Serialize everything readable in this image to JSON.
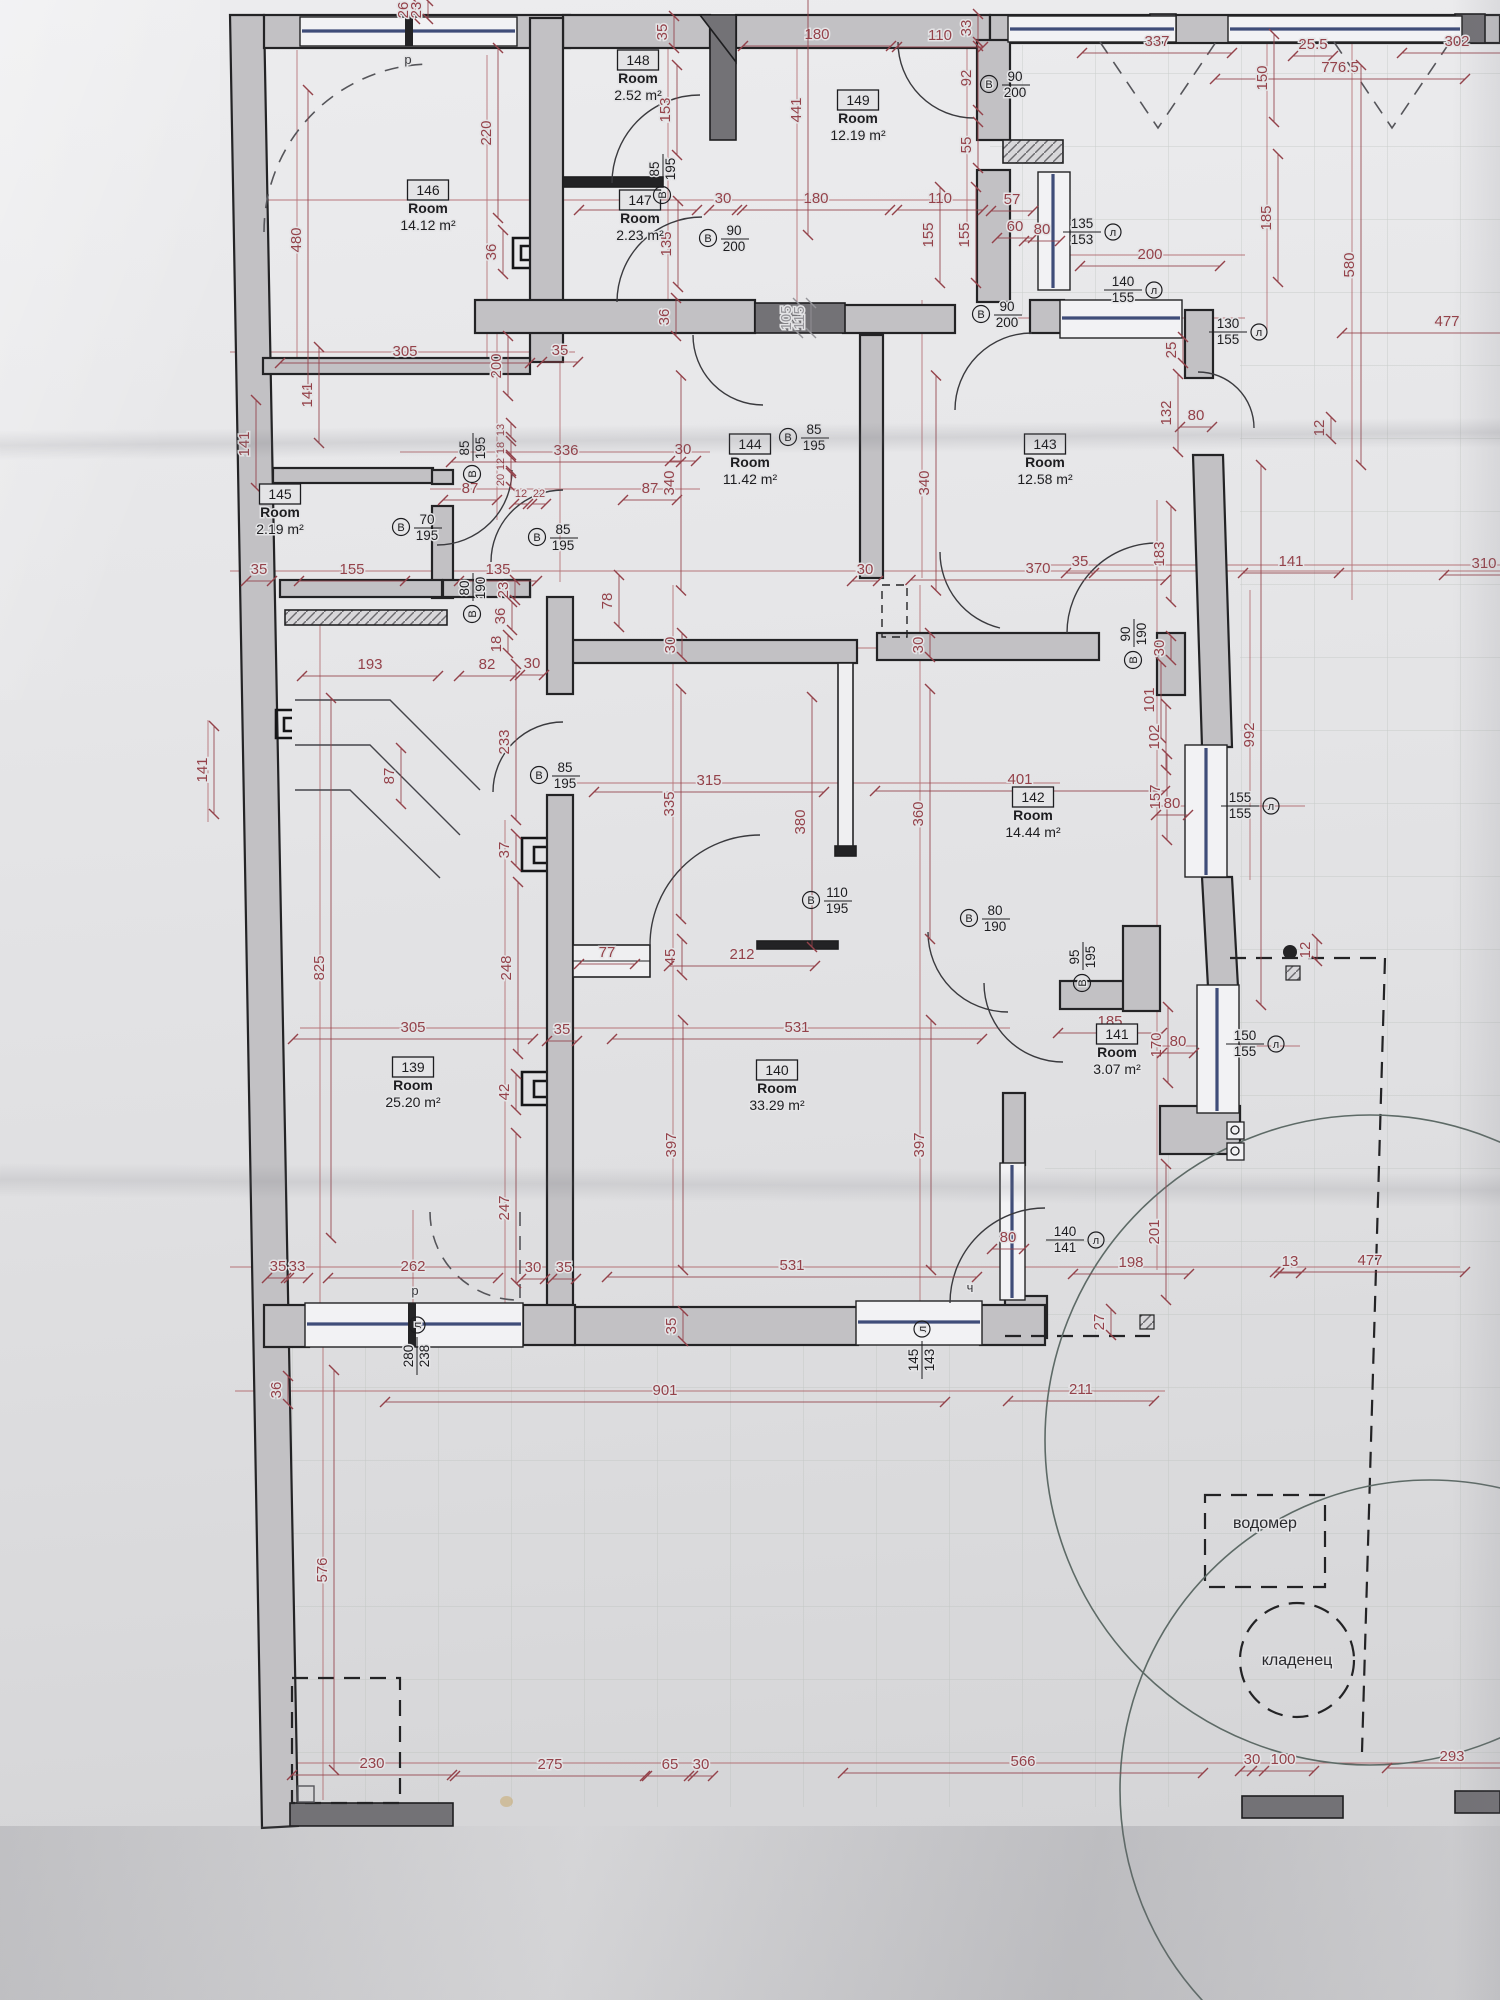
{
  "doc": {
    "kind": "floor plan scan",
    "language": "bg"
  },
  "legend": {
    "door_letter": "В",
    "window_letter": "л"
  },
  "colors": {
    "dim": "#94424a",
    "ink": "#1d1d20",
    "wall": "#c2c1c4",
    "wall_dark": "#737276",
    "glass": "#3f4d79",
    "paper": "#e4e4e6",
    "muted": "#96959a"
  },
  "rooms": [
    {
      "id": "146",
      "label": "Room",
      "area": "14.12 m²",
      "x": 428,
      "y": 208
    },
    {
      "id": "148",
      "label": "Room",
      "area": "2.52 m²",
      "x": 638,
      "y": 78
    },
    {
      "id": "149",
      "label": "Room",
      "area": "12.19 m²",
      "x": 858,
      "y": 118
    },
    {
      "id": "147",
      "label": "Room",
      "area": "2.23 m²",
      "x": 640,
      "y": 218
    },
    {
      "id": "144",
      "label": "Room",
      "area": "11.42 m²",
      "x": 750,
      "y": 462
    },
    {
      "id": "143",
      "label": "Room",
      "area": "12.58 m²",
      "x": 1045,
      "y": 462
    },
    {
      "id": "145",
      "label": "Room",
      "area": "2.19 m²",
      "x": 280,
      "y": 512
    },
    {
      "id": "142",
      "label": "Room",
      "area": "14.44 m²",
      "x": 1033,
      "y": 815
    },
    {
      "id": "141",
      "label": "Room",
      "area": "3.07 m²",
      "x": 1117,
      "y": 1052
    },
    {
      "id": "139",
      "label": "Room",
      "area": "25.20 m²",
      "x": 413,
      "y": 1085
    },
    {
      "id": "140",
      "label": "Room",
      "area": "33.29 m²",
      "x": 777,
      "y": 1088
    }
  ],
  "dims": [
    {
      "t": "26",
      "x": 404,
      "y": 10,
      "r": 1,
      "s": 18
    },
    {
      "t": "23",
      "x": 417,
      "y": 10,
      "r": 1,
      "s": 18
    },
    {
      "t": "220",
      "x": 487,
      "y": 133,
      "r": 1,
      "s": 170
    },
    {
      "t": "480",
      "x": 297,
      "y": 240,
      "r": 1,
      "s": 300
    },
    {
      "t": "305",
      "x": 405,
      "y": 352,
      "s": 250
    },
    {
      "t": "200",
      "x": 497,
      "y": 366,
      "r": 1,
      "s": 60
    },
    {
      "t": "35",
      "x": 560,
      "y": 351,
      "s": 36
    },
    {
      "t": "36",
      "x": 492,
      "y": 252,
      "r": 1,
      "s": 44
    },
    {
      "t": "35",
      "x": 663,
      "y": 32,
      "r": 1,
      "s": 32
    },
    {
      "t": "153",
      "x": 666,
      "y": 110,
      "r": 1,
      "s": 90
    },
    {
      "t": "165",
      "x": 638,
      "y": 199,
      "s": 118
    },
    {
      "t": "30",
      "x": 723,
      "y": 199,
      "s": 28
    },
    {
      "t": "180",
      "x": 816,
      "y": 199,
      "s": 148
    },
    {
      "t": "135",
      "x": 667,
      "y": 244,
      "r": 1,
      "s": 86
    },
    {
      "t": "36",
      "x": 665,
      "y": 317,
      "r": 1,
      "s": 38
    },
    {
      "t": "180",
      "x": 817,
      "y": 35,
      "s": 148
    },
    {
      "t": "441",
      "x": 797,
      "y": 110,
      "r": 1,
      "s": 250
    },
    {
      "t": "110",
      "x": 940,
      "y": 36,
      "s": 86
    },
    {
      "t": "33",
      "x": 967,
      "y": 28,
      "r": 1,
      "s": 28
    },
    {
      "t": "92",
      "x": 967,
      "y": 78,
      "r": 1,
      "s": 64
    },
    {
      "t": "55",
      "x": 967,
      "y": 145,
      "r": 1,
      "s": 46
    },
    {
      "t": "110",
      "x": 940,
      "y": 199,
      "s": 86
    },
    {
      "t": "57",
      "x": 1012,
      "y": 200,
      "s": 42
    },
    {
      "t": "155",
      "x": 929,
      "y": 235,
      "r": 1,
      "s": 96
    },
    {
      "t": "155",
      "x": 965,
      "y": 235,
      "r": 1,
      "s": 96
    },
    {
      "t": "60",
      "x": 1015,
      "y": 227,
      "s": 36
    },
    {
      "t": "80",
      "x": 1042,
      "y": 230,
      "s": 36
    },
    {
      "t": "337",
      "x": 1157,
      "y": 42,
      "s": 150
    },
    {
      "t": "25.5",
      "x": 1313,
      "y": 45,
      "s": 40
    },
    {
      "t": "776.5",
      "x": 1340,
      "y": 68,
      "s": 250
    },
    {
      "t": "150",
      "x": 1263,
      "y": 78,
      "r": 1,
      "s": 88
    },
    {
      "t": "302",
      "x": 1457,
      "y": 42,
      "s": 110
    },
    {
      "t": "200",
      "x": 1150,
      "y": 255,
      "s": 140
    },
    {
      "t": "477",
      "x": 1447,
      "y": 322,
      "s": 210
    },
    {
      "t": "580",
      "x": 1350,
      "y": 265,
      "r": 1,
      "s": 400
    },
    {
      "t": "185",
      "x": 1267,
      "y": 218,
      "r": 1,
      "s": 128
    },
    {
      "t": "105",
      "x": 787,
      "y": 318,
      "r": 1,
      "s": 30,
      "c": "muted"
    },
    {
      "t": "115",
      "x": 800,
      "y": 318,
      "r": 1,
      "s": 30,
      "c": "muted"
    },
    {
      "t": "13",
      "x": 500,
      "y": 430,
      "r": 1,
      "s": 14,
      "f": 11
    },
    {
      "t": "18",
      "x": 500,
      "y": 448,
      "r": 1,
      "s": 14,
      "f": 11
    },
    {
      "t": "12",
      "x": 500,
      "y": 464,
      "r": 1,
      "s": 14,
      "f": 11
    },
    {
      "t": "20",
      "x": 500,
      "y": 480,
      "r": 1,
      "s": 14,
      "f": 11
    },
    {
      "t": "12",
      "x": 521,
      "y": 493,
      "s": 14,
      "f": 11
    },
    {
      "t": "22",
      "x": 539,
      "y": 493,
      "s": 14,
      "f": 11
    },
    {
      "t": "141",
      "x": 308,
      "y": 395,
      "r": 1,
      "s": 96
    },
    {
      "t": "141",
      "x": 245,
      "y": 444,
      "r": 1,
      "s": 88
    },
    {
      "t": "87",
      "x": 470,
      "y": 489,
      "s": 54
    },
    {
      "t": "87",
      "x": 650,
      "y": 489,
      "s": 54
    },
    {
      "t": "336",
      "x": 566,
      "y": 451,
      "s": 230
    },
    {
      "t": "30",
      "x": 683,
      "y": 450,
      "s": 26
    },
    {
      "t": "340",
      "x": 670,
      "y": 483,
      "r": 1,
      "s": 215
    },
    {
      "t": "340",
      "x": 925,
      "y": 483,
      "r": 1,
      "s": 215
    },
    {
      "t": "370",
      "x": 1038,
      "y": 569,
      "s": 255
    },
    {
      "t": "30",
      "x": 865,
      "y": 570,
      "s": 26
    },
    {
      "t": "35",
      "x": 1080,
      "y": 562,
      "s": 28
    },
    {
      "t": "141",
      "x": 1291,
      "y": 562,
      "s": 96
    },
    {
      "t": "310",
      "x": 1484,
      "y": 564,
      "s": 80
    },
    {
      "t": "12",
      "x": 1320,
      "y": 428,
      "r": 1,
      "s": 22
    },
    {
      "t": "25",
      "x": 1172,
      "y": 350,
      "r": 1,
      "s": 26
    },
    {
      "t": "132",
      "x": 1167,
      "y": 413,
      "r": 1,
      "s": 78
    },
    {
      "t": "80",
      "x": 1196,
      "y": 416,
      "s": 32
    },
    {
      "t": "183",
      "x": 1160,
      "y": 554,
      "r": 1,
      "s": 96
    },
    {
      "t": "155",
      "x": 352,
      "y": 570,
      "s": 106
    },
    {
      "t": "35",
      "x": 259,
      "y": 570,
      "s": 26
    },
    {
      "t": "135",
      "x": 498,
      "y": 570,
      "s": 78
    },
    {
      "t": "23",
      "x": 504,
      "y": 590,
      "r": 1,
      "s": 20
    },
    {
      "t": "36",
      "x": 501,
      "y": 616,
      "r": 1,
      "s": 28
    },
    {
      "t": "18",
      "x": 497,
      "y": 644,
      "r": 1,
      "s": 18
    },
    {
      "t": "193",
      "x": 370,
      "y": 665,
      "s": 136
    },
    {
      "t": "82",
      "x": 487,
      "y": 665,
      "s": 56
    },
    {
      "t": "30",
      "x": 532,
      "y": 664,
      "s": 24
    },
    {
      "t": "233",
      "x": 505,
      "y": 742,
      "r": 1,
      "s": 156
    },
    {
      "t": "141",
      "x": 203,
      "y": 770,
      "r": 1,
      "s": 88
    },
    {
      "t": "87",
      "x": 390,
      "y": 776,
      "r": 1,
      "s": 56
    },
    {
      "t": "78",
      "x": 608,
      "y": 601,
      "r": 1,
      "s": 52
    },
    {
      "t": "30",
      "x": 671,
      "y": 645,
      "r": 1,
      "s": 24
    },
    {
      "t": "30",
      "x": 919,
      "y": 645,
      "r": 1,
      "s": 24
    },
    {
      "t": "315",
      "x": 709,
      "y": 781,
      "s": 230
    },
    {
      "t": "335",
      "x": 670,
      "y": 804,
      "r": 1,
      "s": 230
    },
    {
      "t": "380",
      "x": 801,
      "y": 822,
      "r": 1,
      "s": 250
    },
    {
      "t": "360",
      "x": 919,
      "y": 814,
      "r": 1,
      "s": 250
    },
    {
      "t": "401",
      "x": 1020,
      "y": 780,
      "s": 290
    },
    {
      "t": "157",
      "x": 1156,
      "y": 797,
      "r": 1,
      "s": 86
    },
    {
      "t": "80",
      "x": 1172,
      "y": 804,
      "s": 32
    },
    {
      "t": "992",
      "x": 1250,
      "y": 735,
      "r": 1,
      "s": 540
    },
    {
      "t": "101",
      "x": 1150,
      "y": 700,
      "r": 1,
      "s": 76
    },
    {
      "t": "102",
      "x": 1155,
      "y": 737,
      "r": 1,
      "s": 66
    },
    {
      "t": "30",
      "x": 1160,
      "y": 648,
      "r": 1,
      "s": 24
    },
    {
      "t": "825",
      "x": 320,
      "y": 968,
      "r": 1,
      "s": 540
    },
    {
      "t": "248",
      "x": 507,
      "y": 968,
      "r": 1,
      "s": 172
    },
    {
      "t": "37",
      "x": 505,
      "y": 850,
      "r": 1,
      "s": 32
    },
    {
      "t": "42",
      "x": 505,
      "y": 1092,
      "r": 1,
      "s": 36
    },
    {
      "t": "305",
      "x": 413,
      "y": 1028,
      "s": 240
    },
    {
      "t": "35",
      "x": 562,
      "y": 1030,
      "s": 30
    },
    {
      "t": "77",
      "x": 607,
      "y": 953,
      "s": 56
    },
    {
      "t": "45",
      "x": 671,
      "y": 957,
      "r": 1,
      "s": 36
    },
    {
      "t": "212",
      "x": 742,
      "y": 955,
      "s": 146
    },
    {
      "t": "185",
      "x": 1110,
      "y": 1022,
      "s": 104
    },
    {
      "t": "170",
      "x": 1157,
      "y": 1045,
      "r": 1,
      "s": 76
    },
    {
      "t": "80",
      "x": 1178,
      "y": 1042,
      "s": 32
    },
    {
      "t": "397",
      "x": 672,
      "y": 1145,
      "r": 1,
      "s": 250
    },
    {
      "t": "397",
      "x": 920,
      "y": 1145,
      "r": 1,
      "s": 250
    },
    {
      "t": "531",
      "x": 797,
      "y": 1028,
      "s": 370
    },
    {
      "t": "531",
      "x": 792,
      "y": 1266,
      "s": 370
    },
    {
      "t": "201",
      "x": 1155,
      "y": 1232,
      "r": 1,
      "s": 136
    },
    {
      "t": "198",
      "x": 1131,
      "y": 1263,
      "s": 116
    },
    {
      "t": "13",
      "x": 1290,
      "y": 1262,
      "s": 22
    },
    {
      "t": "477",
      "x": 1370,
      "y": 1261,
      "s": 190
    },
    {
      "t": "12",
      "x": 1306,
      "y": 950,
      "r": 1,
      "s": 22
    },
    {
      "t": "27",
      "x": 1100,
      "y": 1322,
      "r": 1,
      "s": 26
    },
    {
      "t": "80",
      "x": 1008,
      "y": 1238,
      "s": 32
    },
    {
      "t": "35",
      "x": 672,
      "y": 1326,
      "r": 1,
      "s": 30
    },
    {
      "t": "262",
      "x": 413,
      "y": 1267,
      "s": 170
    },
    {
      "t": "247",
      "x": 505,
      "y": 1208,
      "r": 1,
      "s": 150
    },
    {
      "t": "30",
      "x": 533,
      "y": 1268,
      "s": 24
    },
    {
      "t": "35",
      "x": 564,
      "y": 1268,
      "s": 24
    },
    {
      "t": "35",
      "x": 278,
      "y": 1267,
      "s": 22
    },
    {
      "t": "33",
      "x": 297,
      "y": 1267,
      "s": 22
    },
    {
      "t": "36",
      "x": 277,
      "y": 1390,
      "r": 1,
      "s": 28
    },
    {
      "t": "901",
      "x": 665,
      "y": 1391,
      "s": 560
    },
    {
      "t": "211",
      "x": 1081,
      "y": 1390,
      "s": 146
    },
    {
      "t": "576",
      "x": 323,
      "y": 1570,
      "r": 1,
      "s": 400
    },
    {
      "t": "230",
      "x": 372,
      "y": 1764,
      "s": 160
    },
    {
      "t": "275",
      "x": 550,
      "y": 1765,
      "s": 190
    },
    {
      "t": "65",
      "x": 670,
      "y": 1765,
      "s": 46
    },
    {
      "t": "30",
      "x": 701,
      "y": 1765,
      "s": 24
    },
    {
      "t": "566",
      "x": 1023,
      "y": 1762,
      "s": 360
    },
    {
      "t": "30",
      "x": 1252,
      "y": 1760,
      "s": 24
    },
    {
      "t": "100",
      "x": 1283,
      "y": 1760,
      "s": 62
    },
    {
      "t": "293",
      "x": 1452,
      "y": 1757,
      "s": 130
    }
  ],
  "doors": [
    {
      "w": "85",
      "h": "195",
      "x": 660,
      "y": 176,
      "r": 1
    },
    {
      "w": "90",
      "h": "200",
      "x": 727,
      "y": 236,
      "r": 0
    },
    {
      "w": "90",
      "h": "200",
      "x": 1008,
      "y": 82,
      "r": 0
    },
    {
      "w": "90",
      "h": "200",
      "x": 1000,
      "y": 312,
      "r": 0
    },
    {
      "w": "70",
      "h": "195",
      "x": 420,
      "y": 525,
      "r": 0
    },
    {
      "w": "85",
      "h": "195",
      "x": 556,
      "y": 535,
      "r": 0
    },
    {
      "w": "85",
      "h": "195",
      "x": 470,
      "y": 455,
      "r": 1
    },
    {
      "w": "85",
      "h": "195",
      "x": 807,
      "y": 435,
      "r": 0
    },
    {
      "w": "85",
      "h": "195",
      "x": 558,
      "y": 773,
      "r": 0
    },
    {
      "w": "80",
      "h": "190",
      "x": 470,
      "y": 595,
      "r": 1
    },
    {
      "w": "80",
      "h": "190",
      "x": 988,
      "y": 916,
      "r": 0
    },
    {
      "w": "90",
      "h": "190",
      "x": 1131,
      "y": 641,
      "r": 1
    },
    {
      "w": "110",
      "h": "195",
      "x": 830,
      "y": 898,
      "r": 0
    },
    {
      "w": "95",
      "h": "195",
      "x": 1080,
      "y": 964,
      "r": 1
    }
  ],
  "windows": [
    {
      "a": "135",
      "b": "153",
      "x": 1082,
      "y": 230,
      "r": 0
    },
    {
      "a": "140",
      "b": "155",
      "x": 1123,
      "y": 288,
      "r": 0
    },
    {
      "a": "130",
      "b": "155",
      "x": 1228,
      "y": 330,
      "r": 0
    },
    {
      "a": "155",
      "b": "155",
      "x": 1240,
      "y": 804,
      "r": 0
    },
    {
      "a": "150",
      "b": "155",
      "x": 1245,
      "y": 1042,
      "r": 0
    },
    {
      "a": "140",
      "b": "141",
      "x": 1065,
      "y": 1238,
      "r": 0
    },
    {
      "a": "145",
      "b": "143",
      "x": 920,
      "y": 1360,
      "r": 1
    },
    {
      "a": "280",
      "b": "238",
      "x": 415,
      "y": 1356,
      "r": 1
    }
  ],
  "notes": [
    {
      "t": "водомер",
      "x": 1265,
      "y": 1528
    },
    {
      "t": "кладенец",
      "x": 1297,
      "y": 1665
    }
  ],
  "symbols": [
    {
      "t": "р",
      "x": 408,
      "y": 64
    },
    {
      "t": "р",
      "x": 415,
      "y": 1295
    },
    {
      "t": "ч",
      "x": 970,
      "y": 1292
    }
  ]
}
